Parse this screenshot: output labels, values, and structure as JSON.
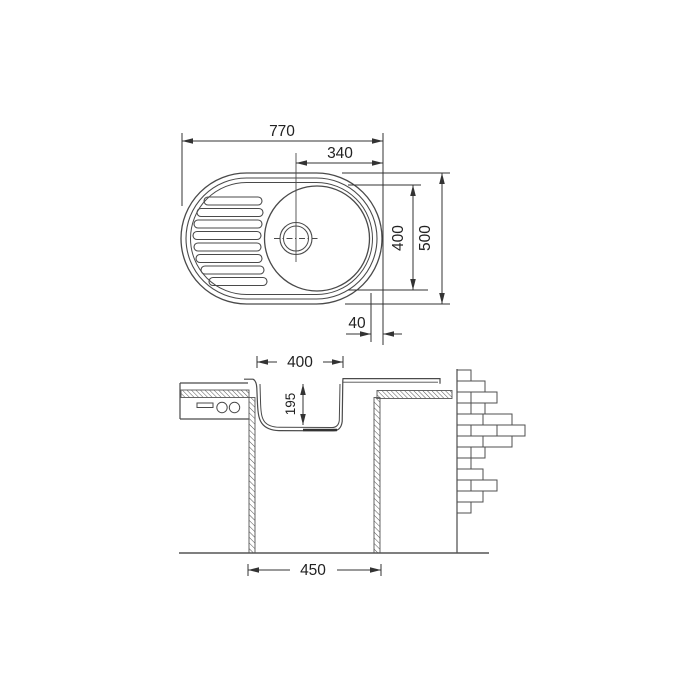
{
  "drawing": {
    "title": "kitchen-sink-technical-drawing",
    "line_color": "#4a4a4a",
    "dimension_color": "#333333",
    "background": "#ffffff",
    "top_view": {
      "overall_width": "770",
      "bowl_offset": "340",
      "bowl_diameter": "400",
      "overall_depth": "500",
      "edge_offset": "40"
    },
    "section_view": {
      "bowl_width": "400",
      "bowl_depth": "195",
      "base_width": "450"
    }
  }
}
